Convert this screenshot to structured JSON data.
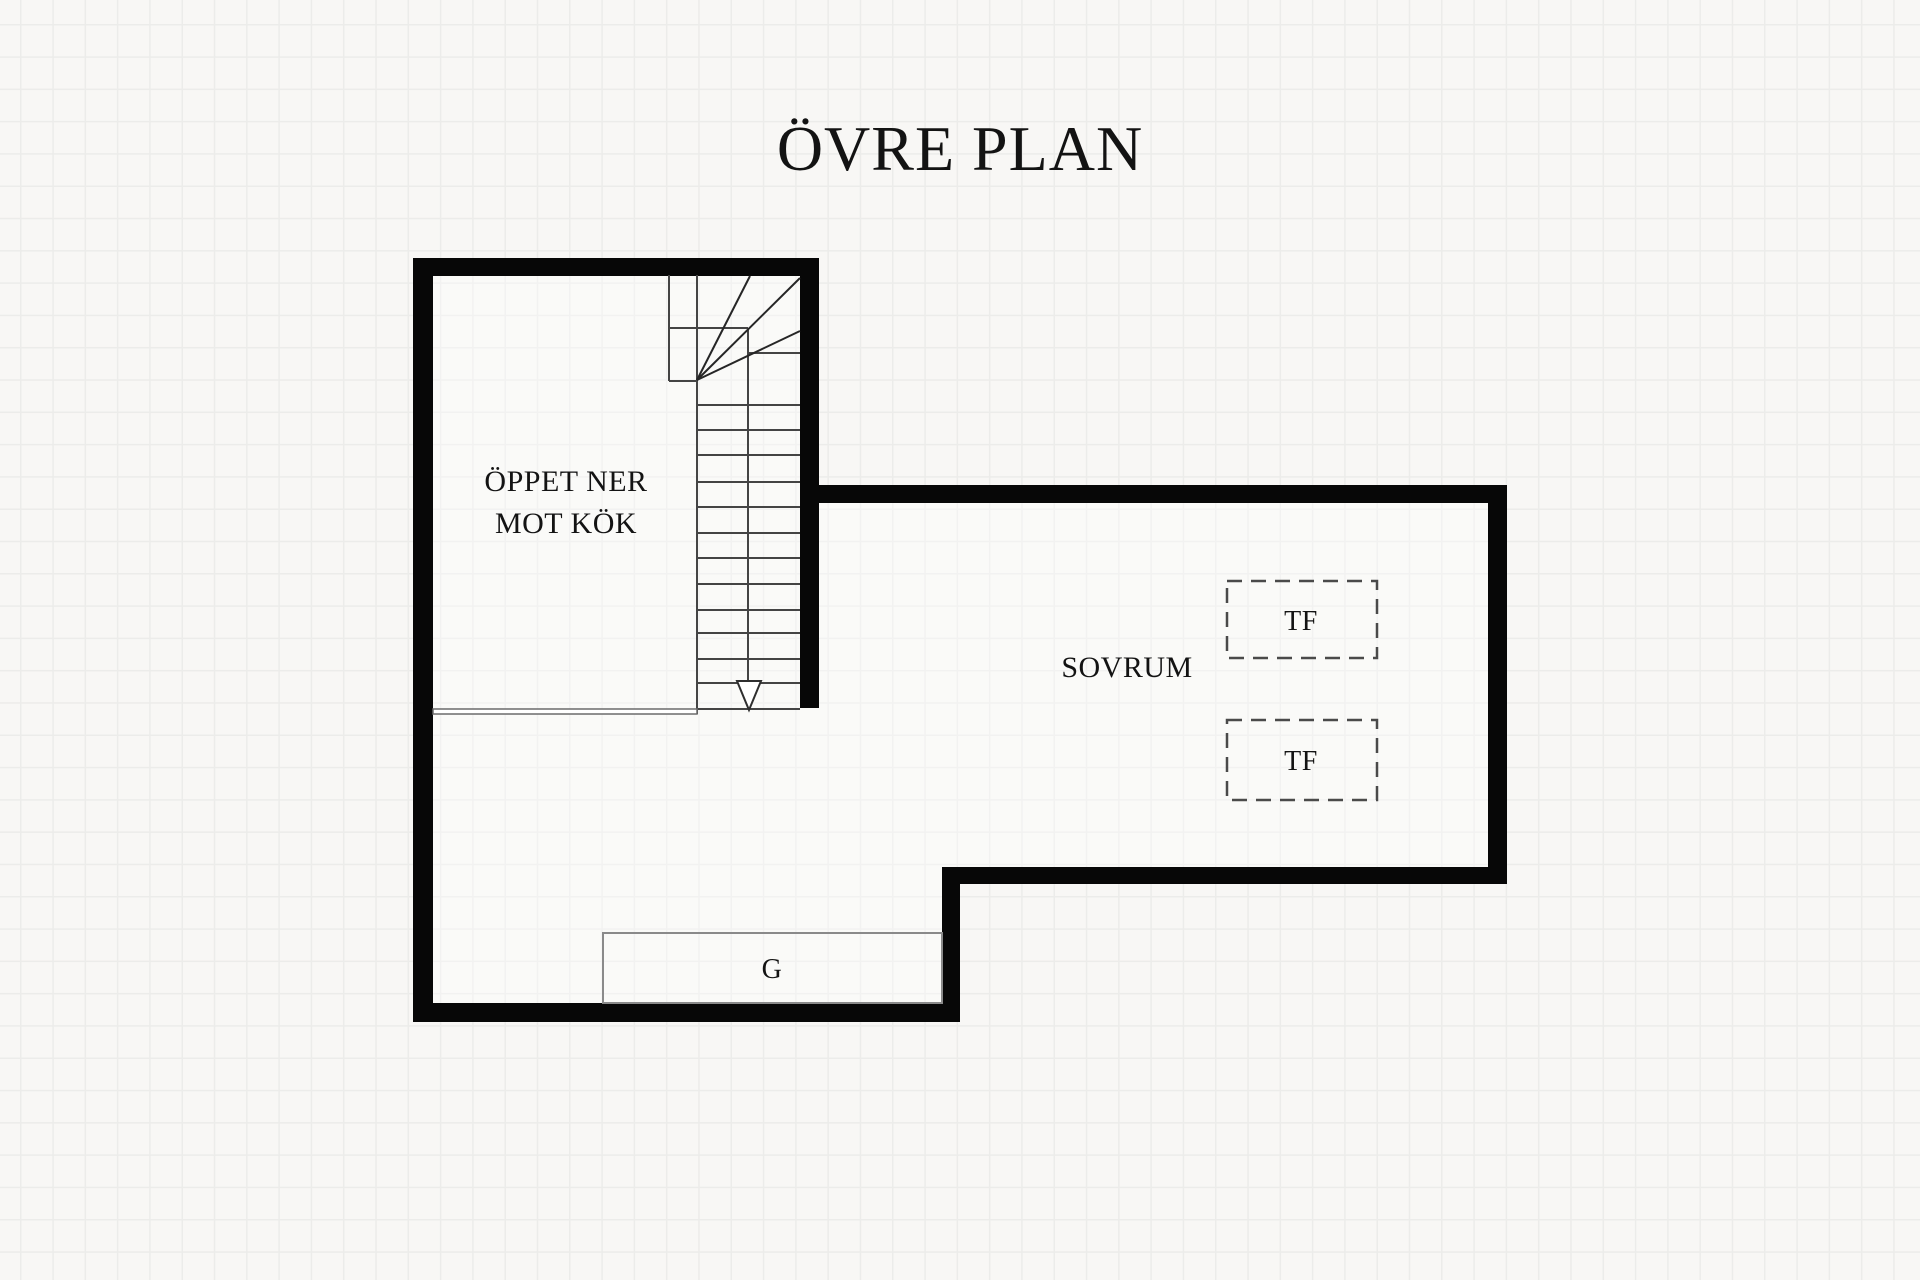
{
  "title": "ÖVRE PLAN",
  "rooms": {
    "open_to_below": {
      "line1": "ÖPPET NER",
      "line2": "MOT KÖK"
    },
    "bedroom": {
      "label": "SOVRUM"
    }
  },
  "features": {
    "roof_window_top": "TF",
    "roof_window_bottom": "TF",
    "wardrobe": "G"
  },
  "colors": {
    "background": "#f8f7f5",
    "grid_line": "#ececea",
    "wall": "#070707",
    "stair_line": "#444444",
    "dashed_outline": "#4a4a4a",
    "thin_outline": "#8a8a8a",
    "text": "#131313"
  }
}
